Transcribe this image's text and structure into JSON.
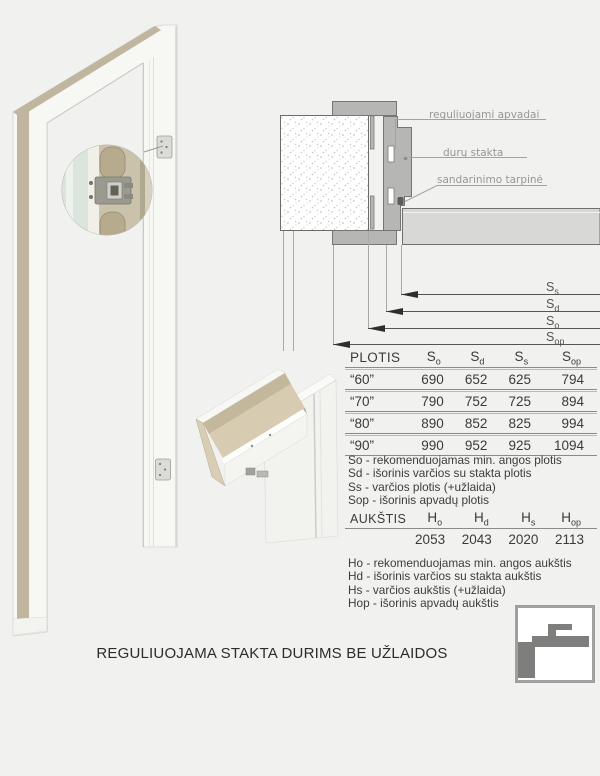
{
  "caption": "REGULIUOJAMA STAKTA DURIMS BE UŽLAIDOS",
  "diagram_labels": {
    "apvadai": "reguliuojami apvadai",
    "stakta": "durų stakta",
    "tarpine": "sandarinimo tarpinė"
  },
  "dim_labels": [
    {
      "base": "S",
      "sub": "s"
    },
    {
      "base": "S",
      "sub": "d"
    },
    {
      "base": "S",
      "sub": "o"
    },
    {
      "base": "S",
      "sub": "op"
    }
  ],
  "plotis": {
    "title": "PLOTIS",
    "columns": [
      {
        "base": "S",
        "sub": "o"
      },
      {
        "base": "S",
        "sub": "d"
      },
      {
        "base": "S",
        "sub": "s"
      },
      {
        "base": "S",
        "sub": "op"
      }
    ],
    "rows": [
      {
        "label": "“60”",
        "values": [
          "690",
          "652",
          "625",
          "794"
        ]
      },
      {
        "label": "“70”",
        "values": [
          "790",
          "752",
          "725",
          "894"
        ]
      },
      {
        "label": "“80”",
        "values": [
          "890",
          "852",
          "825",
          "994"
        ]
      },
      {
        "label": "“90”",
        "values": [
          "990",
          "952",
          "925",
          "1094"
        ]
      }
    ],
    "legend": [
      "So - rekomenduojamas min. angos plotis",
      "Sd - išorinis varčios su stakta plotis",
      "Ss - varčios plotis (+užlaida)",
      "Sop - išorinis apvadų plotis"
    ]
  },
  "aukstis": {
    "title": "AUKŠTIS",
    "columns": [
      {
        "base": "H",
        "sub": "o"
      },
      {
        "base": "H",
        "sub": "d"
      },
      {
        "base": "H",
        "sub": "s"
      },
      {
        "base": "H",
        "sub": "op"
      }
    ],
    "values": [
      "2053",
      "2043",
      "2020",
      "2113"
    ],
    "legend": [
      "Ho - rekomenduojamas min. angos aukštis",
      "Hd - išorinis varčios su stakta aukštis",
      "Hs - varčios aukštis (+užlaida)",
      "Hop - išorinis apvadų aukštis"
    ]
  },
  "colors": {
    "background": "#f1f1ef",
    "section_gray": "#b6b6b4",
    "door_leaf_gray": "#d8d8d6",
    "frame_tan": "#c0b59e",
    "label_gray": "#979793",
    "table_text": "#3a3a3a",
    "logo_gray": "#7e7e7c"
  }
}
